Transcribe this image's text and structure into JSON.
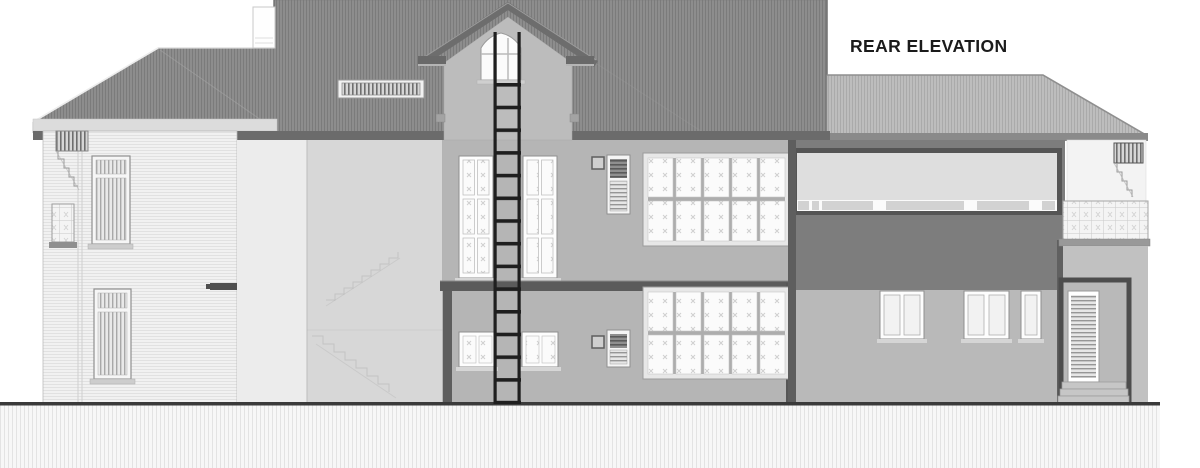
{
  "title": "REAR ELEVATION",
  "drawing": {
    "type": "architectural-elevation",
    "view_label": "REAR ELEVATION",
    "storeys_visible": 2
  },
  "palette": {
    "sky": "#ffffff",
    "roofDark": "#8d8d8d",
    "roofDarkLine": "#7b7b7b",
    "roofLight": "#bdbdbd",
    "roofLightLine": "#aaaaaa",
    "fascia": "#6b6b6b",
    "fasciaLight": "#8a8a8a",
    "wallMain": "#b5b5b5",
    "wallDormer": "#bcbcbc",
    "wallDarkBand": "#7d7d7d",
    "wallLeft": "#f1f1f1",
    "wallRecessed": "#ececec",
    "wallStair": "#d7d7d7",
    "wallRightLower": "#b9b9b9",
    "column": "#5e5e5e",
    "beam": "#5b5b5b",
    "frameWhite": "#fdfdfd",
    "paneLight": "#f4f4f4",
    "glazingBand": "#dedede",
    "ladder": "#1f1f1f",
    "groundLine": "#3a3a3a",
    "ink": "#1b1b1b"
  }
}
